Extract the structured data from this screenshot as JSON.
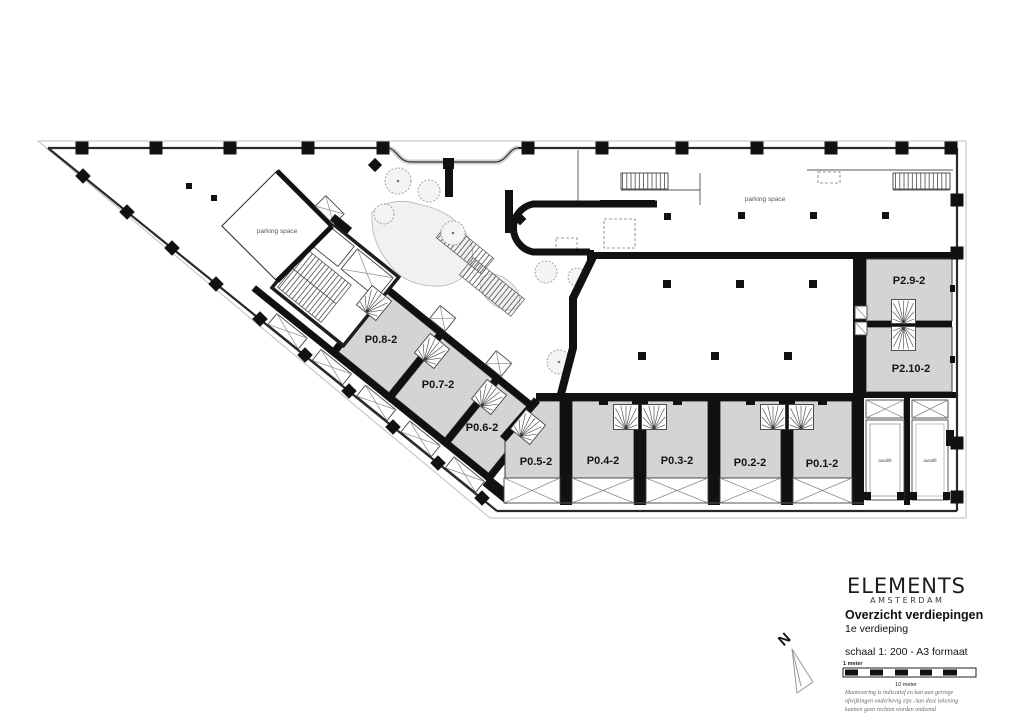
{
  "plan": {
    "rooms": [
      {
        "id": "p0-8",
        "label": "P0.8-2"
      },
      {
        "id": "p0-7",
        "label": "P0.7-2"
      },
      {
        "id": "p0-6",
        "label": "P0.6-2"
      },
      {
        "id": "p0-5",
        "label": "P0.5-2"
      },
      {
        "id": "p0-4",
        "label": "P0.4-2"
      },
      {
        "id": "p0-3",
        "label": "P0.3-2"
      },
      {
        "id": "p0-2",
        "label": "P0.2-2"
      },
      {
        "id": "p0-1",
        "label": "P0.1-2"
      },
      {
        "id": "p2-9",
        "label": "P2.9-2"
      },
      {
        "id": "p2-10",
        "label": "P2.10-2"
      }
    ],
    "labels": {
      "parking_space": "parking space",
      "autolift": "autolift"
    },
    "north": "N",
    "colors": {
      "room_fill": "#d4d4d4",
      "wall": "#111111",
      "line": "#555555"
    }
  },
  "title_block": {
    "brand": "ELEMENTS",
    "brand_sub": "A M S T E R D A M",
    "title": "Overzicht verdiepingen",
    "subtitle": "1e verdieping",
    "scale_note": "schaal 1: 200 - A3 formaat",
    "scalebar_top": "1 meter",
    "scalebar_bottom": "10 meter",
    "disclaimer_lines": [
      "Maatvoering is indicatief en kan aan geringe",
      "afwijkingen onderhevig zijn. Aan deze tekening",
      "kunnen geen rechten worden ontleend"
    ]
  }
}
